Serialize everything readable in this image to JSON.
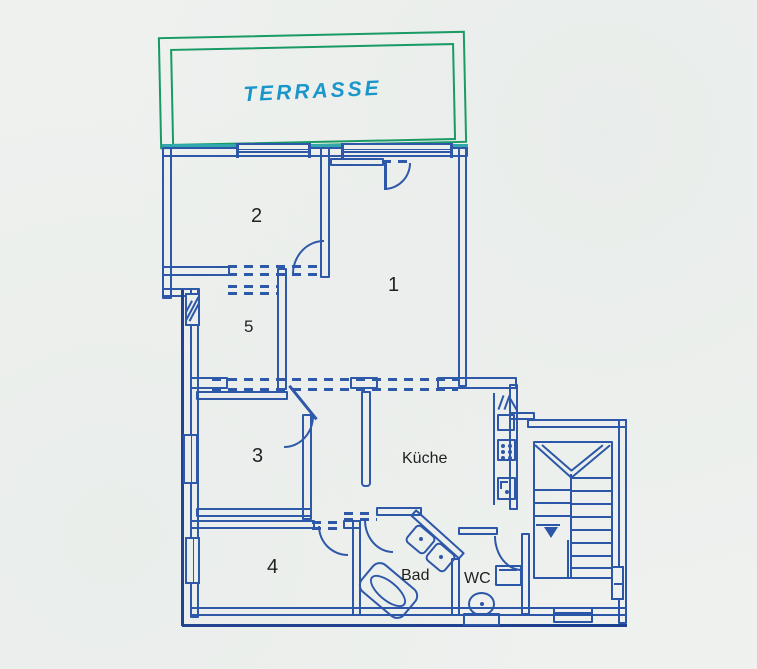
{
  "title": "Apartment floor plan",
  "labels": {
    "terrace": "TERRASSE",
    "room1": "1",
    "room2": "2",
    "room3": "3",
    "room4": "4",
    "room5": "5",
    "kitchen": "Küche",
    "bath": "Bad",
    "wc": "WC"
  },
  "colors": {
    "wall_blue": "#2b55a8",
    "wall_dark_blue": "#1d3f8f",
    "terrace_green": "#169a63",
    "terrace_teal_wall": "#2fa8ac",
    "terrace_text_cyan": "#1795cb",
    "label_black": "#1c1c1c",
    "paper": "#eef1ee"
  }
}
